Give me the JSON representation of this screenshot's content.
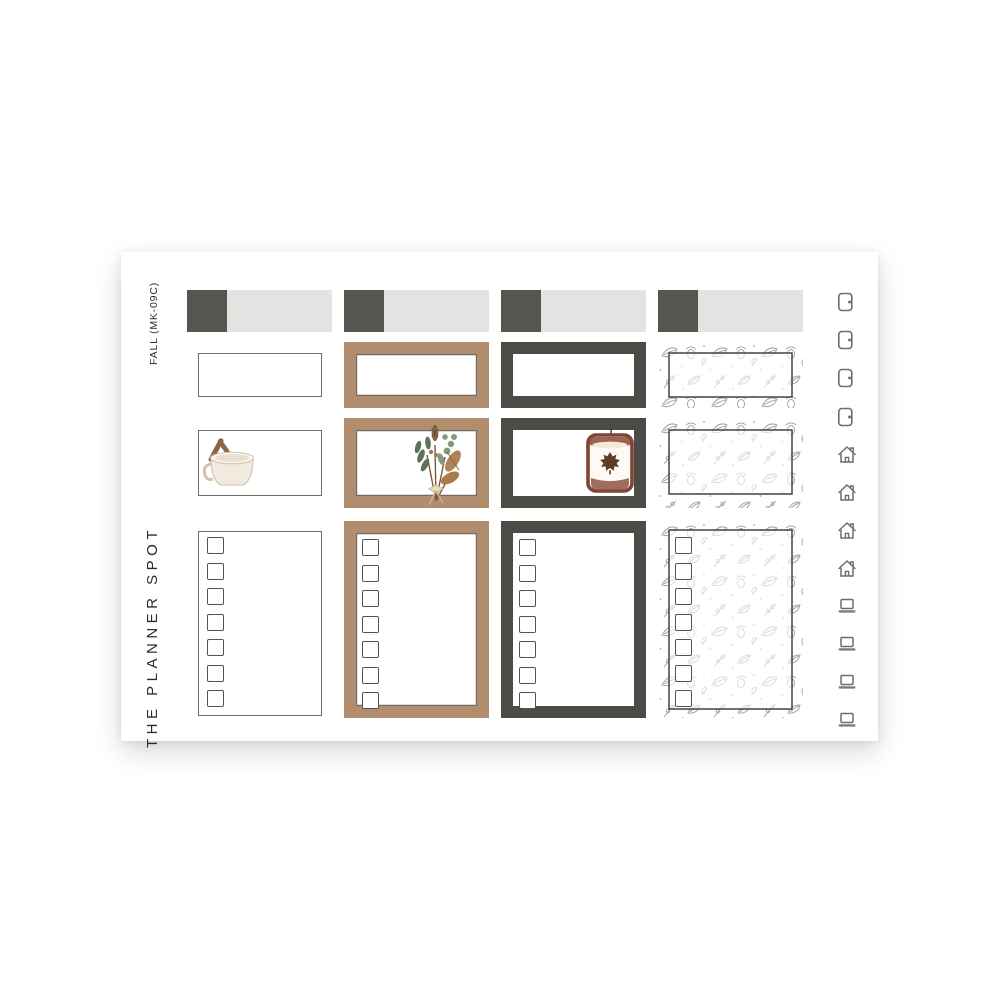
{
  "sheet": {
    "brand": "THE PLANNER SPOT",
    "kit_code": "FALL (MK-09C)"
  },
  "palette": {
    "charcoal": "#57554f",
    "charcoal_deep": "#4d4b45",
    "light_gray": "#e4e3e1",
    "tan": "#b18d6e",
    "outline_gray": "#6e6d6a",
    "doodle_gray": "#a6a6a4",
    "doodle_gray_faint": "#dcdcdc",
    "icon_gray": "#6d6d6a"
  },
  "columns": [
    {
      "id": "col-1",
      "style": "white-outline",
      "rows": [
        "header-bar",
        "blank-box",
        "mixing-bowl-box",
        "checklist-box"
      ]
    },
    {
      "id": "col-2",
      "style": "tan-frame",
      "rows": [
        "header-bar",
        "blank-box",
        "bouquet-box",
        "checklist-box"
      ]
    },
    {
      "id": "col-3",
      "style": "charcoal-frame",
      "rows": [
        "header-bar",
        "blank-box",
        "candle-box",
        "checklist-box"
      ]
    },
    {
      "id": "col-4",
      "style": "fall-doodle-frame",
      "rows": [
        "header-bar",
        "blank-box",
        "blank-box",
        "checklist-box"
      ]
    }
  ],
  "checklist": {
    "checkbox_count": 7
  },
  "icon_rail": {
    "icons": [
      "door",
      "door",
      "door",
      "door",
      "home",
      "home",
      "home",
      "home",
      "laptop",
      "laptop",
      "laptop",
      "laptop"
    ]
  },
  "illustrations": [
    "mixing-bowl",
    "fall-bouquet",
    "fall-candle"
  ]
}
